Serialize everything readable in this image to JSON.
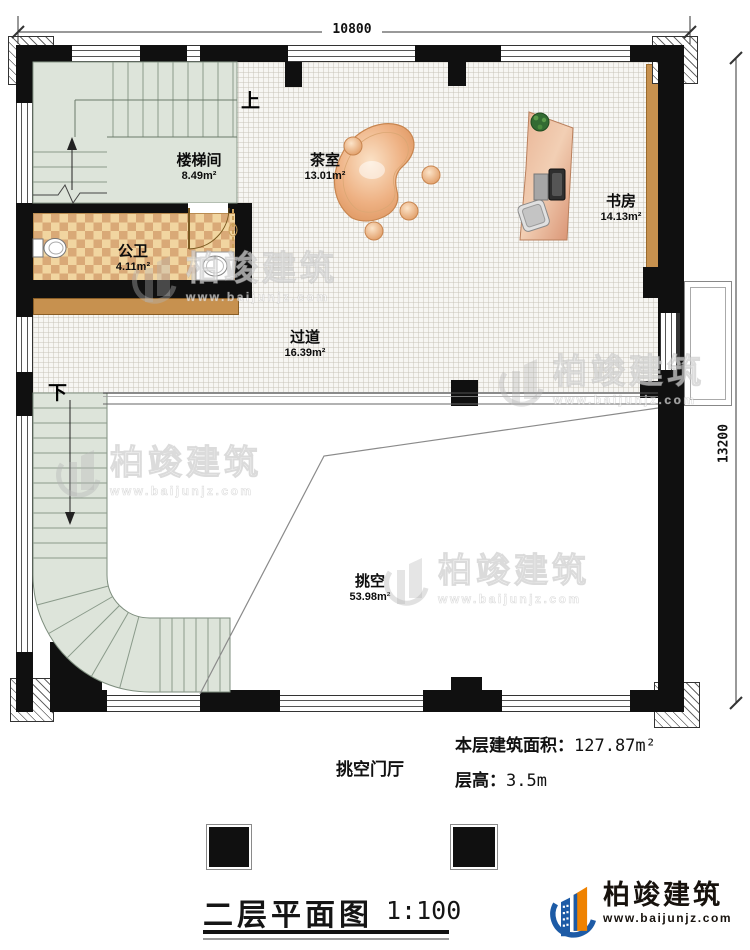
{
  "dimensions": {
    "top": "10800",
    "right": "13200"
  },
  "rooms": [
    {
      "name": "楼梯间",
      "area": "8.49m²"
    },
    {
      "name": "茶室",
      "area": "13.01m²"
    },
    {
      "name": "书房",
      "area": "14.13m²"
    },
    {
      "name": "公卫",
      "area": "4.11m²"
    },
    {
      "name": "过道",
      "area": "16.39m²"
    },
    {
      "name": "挑空",
      "area": "53.98m²"
    }
  ],
  "stairs": {
    "up": "上",
    "down": "下"
  },
  "notes": {
    "hall": "挑空门厅",
    "area_label": "本层建筑面积：",
    "area_value": "127.87m²",
    "height_label": "层高：",
    "height_value": "3.5m"
  },
  "title_block": {
    "title": "二层平面图",
    "scale": "1:100"
  },
  "brand": {
    "name": "柏竣建筑",
    "url": "www.baijunjz.com"
  },
  "watermark": {
    "name": "柏竣建筑",
    "url": "www.baijunjz.com"
  }
}
